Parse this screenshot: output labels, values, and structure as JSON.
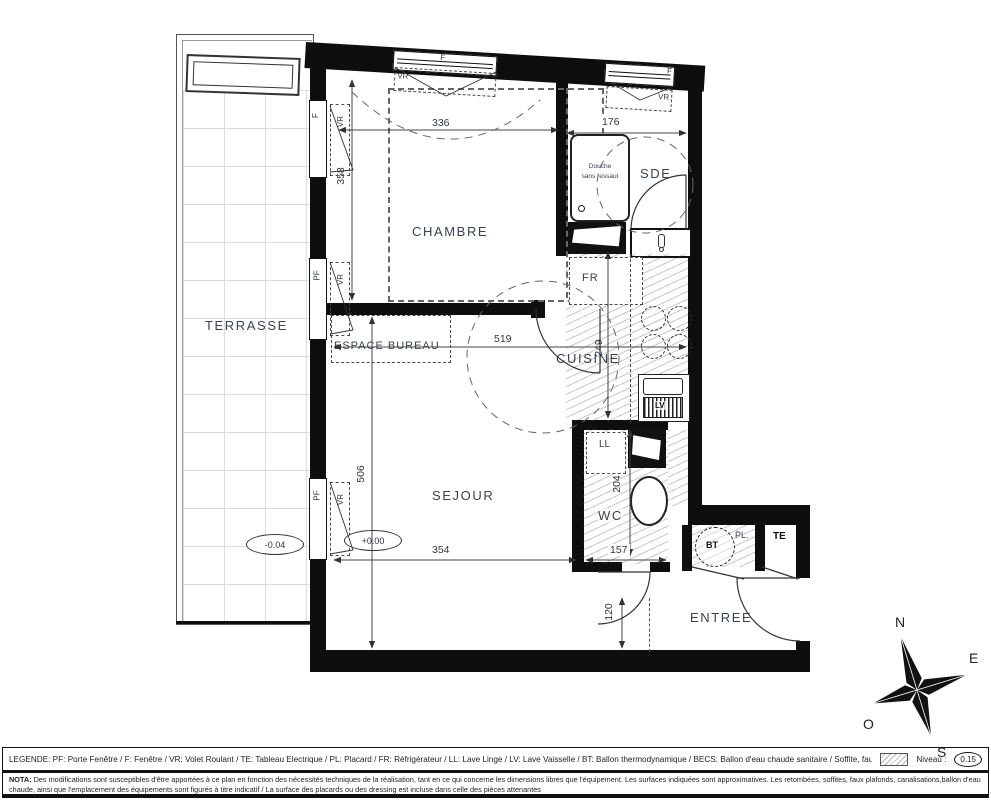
{
  "rooms": {
    "terrasse": "TERRASSE",
    "chambre": "CHAMBRE",
    "espace_bureau": "ESPACE BUREAU",
    "sejour": "SEJOUR",
    "cuisine": "CUISINE",
    "sde": "SDE",
    "wc": "WC",
    "entree": "ENTREE"
  },
  "fixtures": {
    "douche_line1": "Douche",
    "douche_line2": "sans ressaut",
    "fr": "FR",
    "ll": "LL",
    "lv": "LV",
    "bt": "BT",
    "pl": "PL.",
    "te": "TE"
  },
  "openings": {
    "f": "F",
    "pf": "PF",
    "vr": "VR"
  },
  "dims": {
    "d336": "336",
    "d176": "176",
    "d358": "358",
    "d519": "519",
    "d249": "249",
    "d506": "506",
    "d354": "354",
    "d157": "157",
    "d204": "204",
    "d120": "120"
  },
  "levels": {
    "terrasse": "-0.04",
    "sejour": "+0.00"
  },
  "compass": {
    "n": "N",
    "e": "E",
    "s": "S",
    "o": "O"
  },
  "legend": {
    "text": "LEGENDE: PF: Porte Fenêtre / F: Fenêtre / VR: Volet Roulant / TE: Tableau Electrique / PL: Placard / FR: Réfrigérateur / LL: Lave Linge / LV: Lave Vaisselle / BT: Ballon thermodynamique / BECS: Ballon d'eau chaude sanitaire / Soffite, faux plafond:",
    "niveau_label": "Niveau :",
    "niveau_value": "0.15"
  },
  "nota": {
    "label": "NOTA:",
    "text": "Des modifications sont susceptibles d'être apportées à ce plan en fonction des nécessités techniques de la réalisation, tant en ce qui concerne les dimensions libres que l'équipement. Les surfaces indiquées sont approximatives. Les retombées, soffites, faux plafonds, canalisations,ballon d'eau chaude, ainsi que l'emplacement des équipements sont figurés à titre indicatif / La surface des placards ou des dressing est incluse dans celle des pièces attenantes"
  }
}
